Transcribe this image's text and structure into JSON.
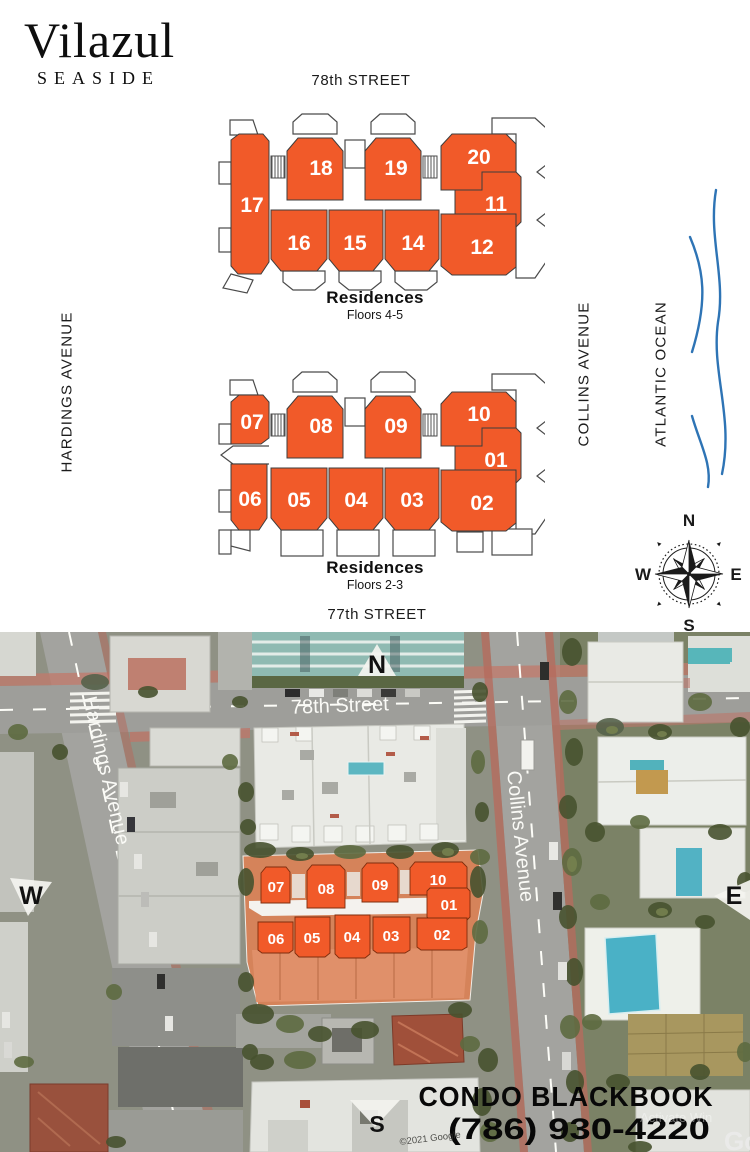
{
  "brand": {
    "name": "Vilazul",
    "subtitle": "SEASIDE"
  },
  "top_labels": {
    "street_top": "78th STREET",
    "street_bottom": "77th STREET",
    "avenue_left": "HARDINGS AVENUE",
    "avenue_right": "COLLINS AVENUE",
    "ocean": "ATLANTIC OCEAN"
  },
  "compass": {
    "north": "N",
    "east": "E",
    "south": "S",
    "west": "W"
  },
  "plans": [
    {
      "title": "Residences",
      "subtitle": "Floors 4-5",
      "units": [
        "17",
        "18",
        "19",
        "20",
        "11",
        "12",
        "16",
        "15",
        "14"
      ]
    },
    {
      "title": "Residences",
      "subtitle": "Floors 2-3",
      "units": [
        "07",
        "08",
        "09",
        "10",
        "01",
        "02",
        "06",
        "05",
        "04",
        "03"
      ]
    }
  ],
  "map": {
    "street": "78th Street",
    "avenue_left": "Hardings Avenue",
    "avenue_right": "Collins Avenue",
    "marker_north": "N",
    "marker_west": "W",
    "marker_east": "E",
    "marker_south": "S",
    "overlay_units": [
      "07",
      "08",
      "09",
      "10",
      "01",
      "06",
      "05",
      "04",
      "03",
      "02"
    ],
    "credit": "©2021 Google",
    "watermark": "Activate Win",
    "logo_fragment": "Go"
  },
  "footer": {
    "company": "CONDO BLACKBOOK",
    "phone": "(786) 930-4220"
  },
  "colors": {
    "accent": "#F15A29",
    "ocean_line": "#2E74B5"
  }
}
